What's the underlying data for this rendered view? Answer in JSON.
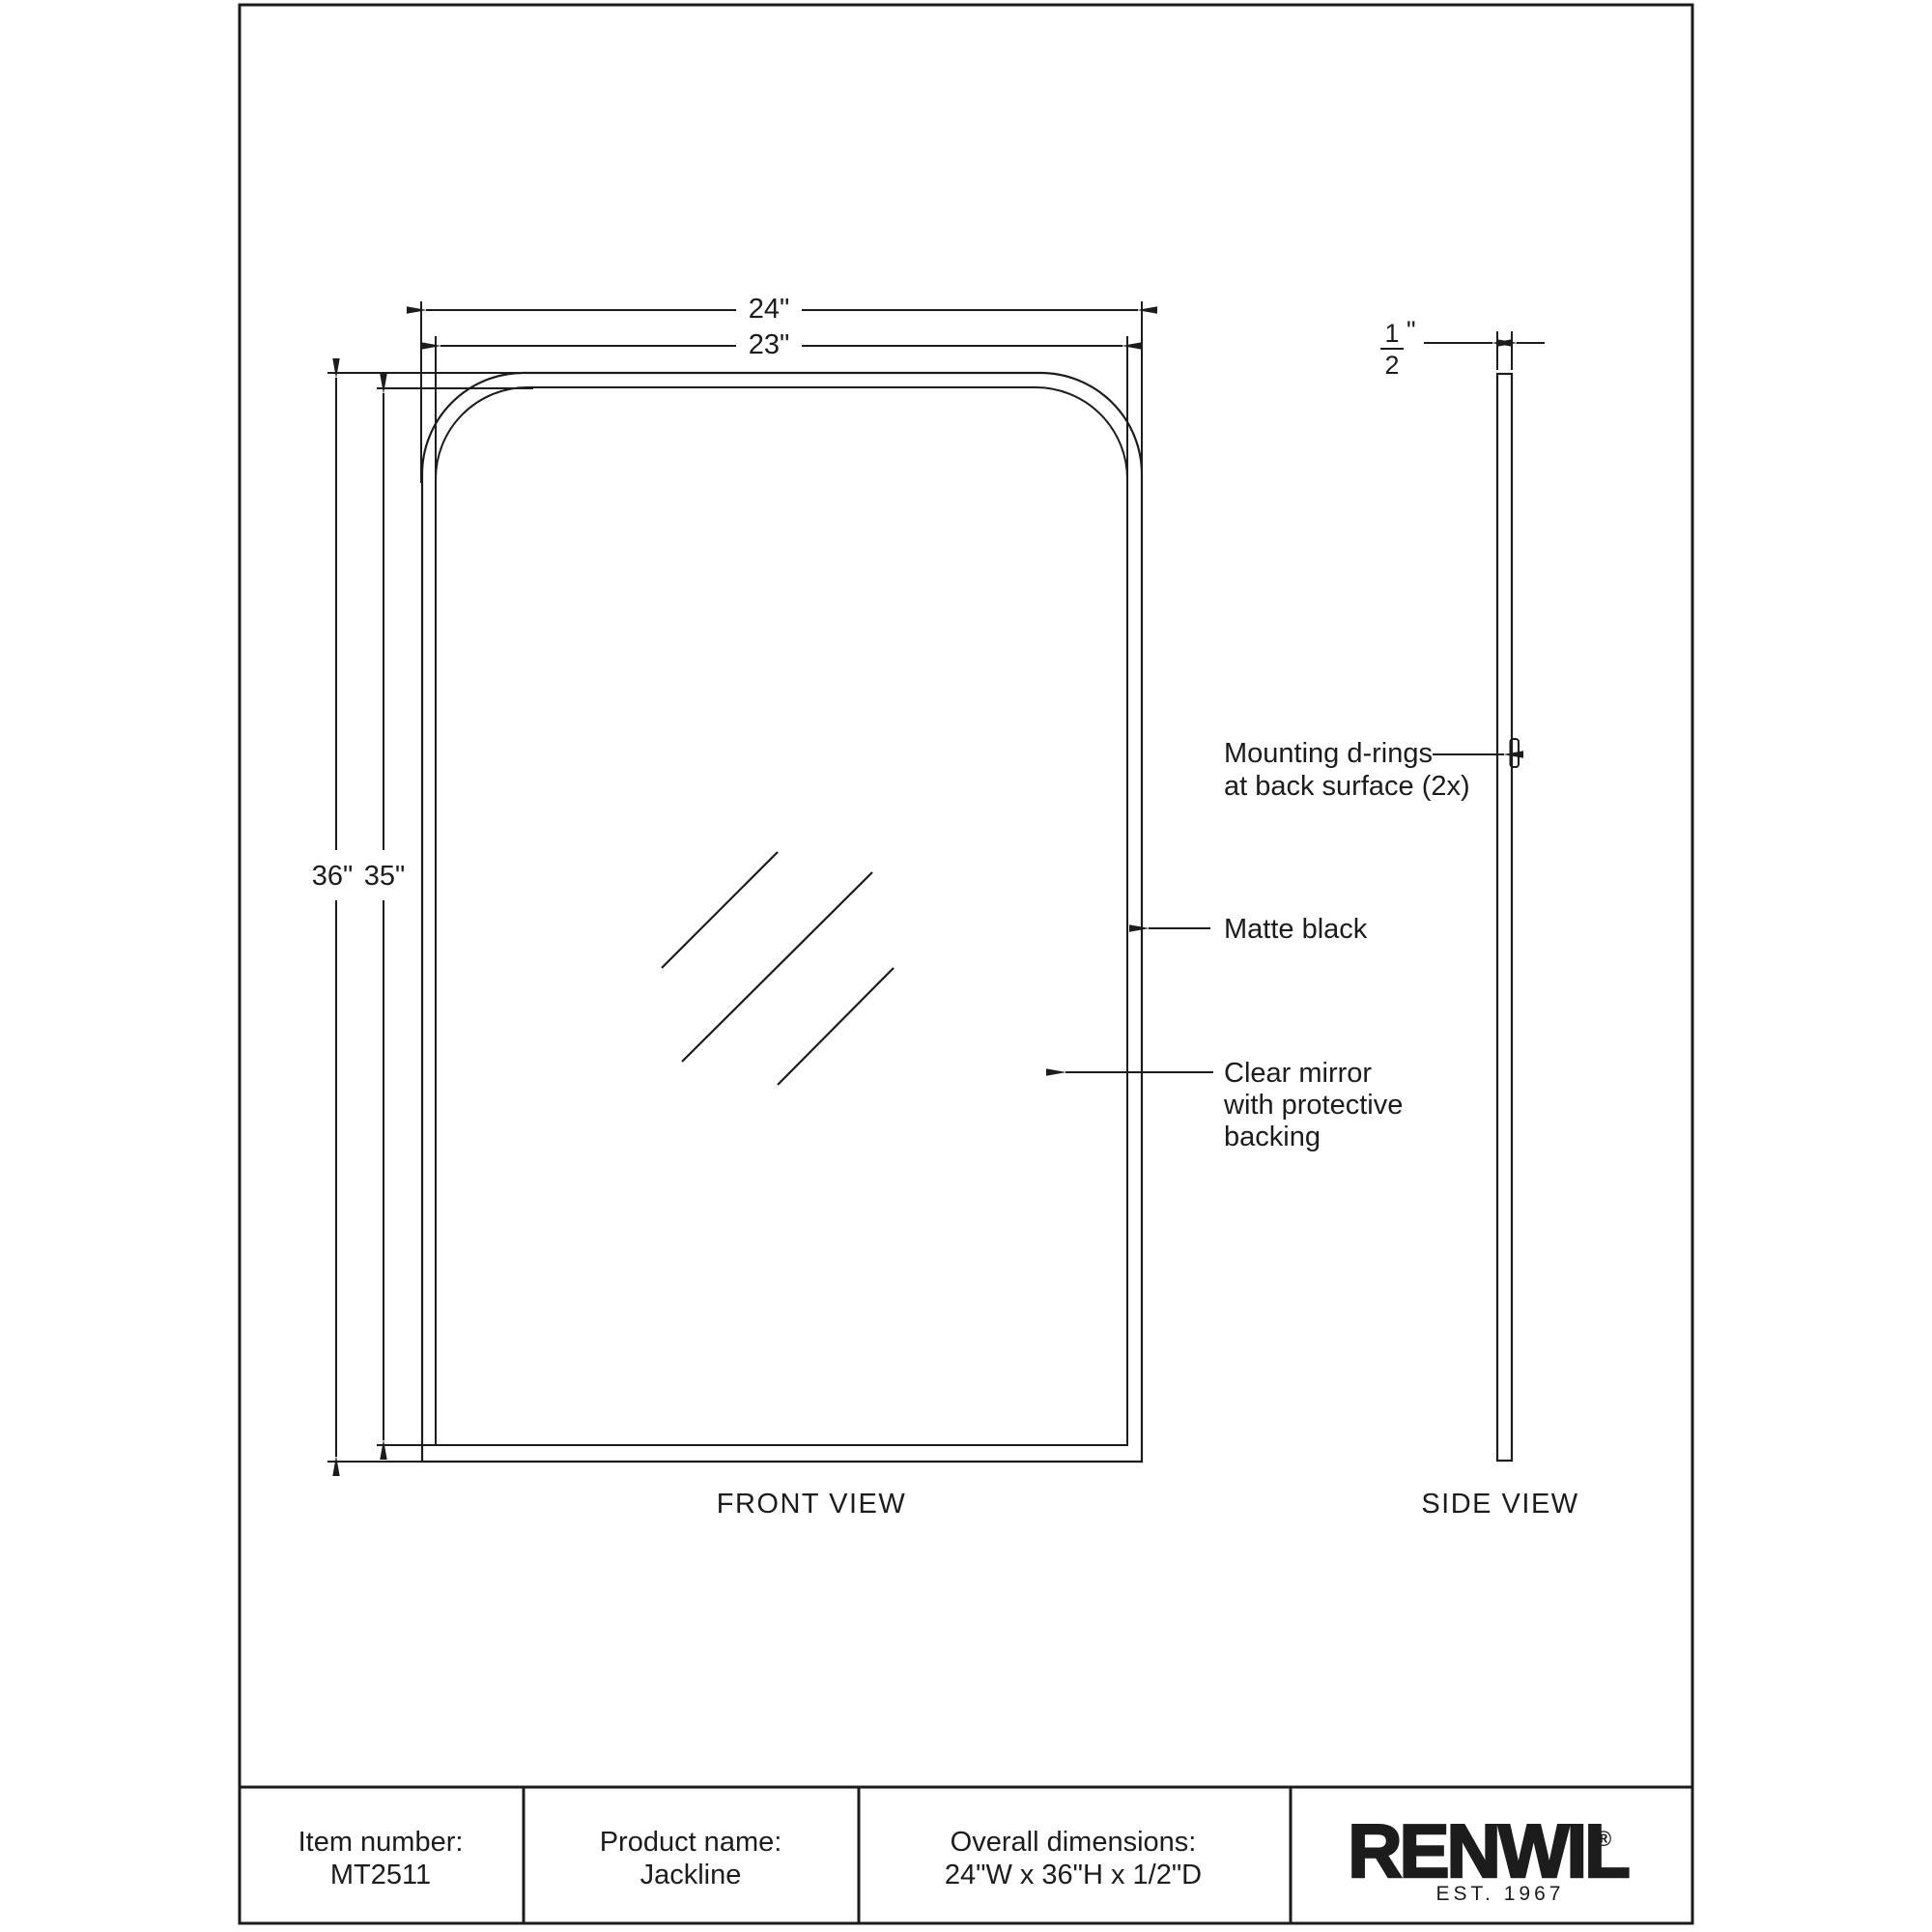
{
  "page": {
    "front_view": {
      "label": "FRONT VIEW",
      "dim_width_outer": "24\"",
      "dim_width_inner": "23\"",
      "dim_height_outer": "36\"",
      "dim_height_inner": "35\""
    },
    "side_view": {
      "label": "SIDE VIEW",
      "dim_depth": {
        "numerator": "1",
        "denominator": "2",
        "unit": "\""
      }
    },
    "annotations": {
      "mounting": {
        "line1": "Mounting d-rings",
        "line2": "at back surface (2x)"
      },
      "frame_finish": "Matte black",
      "mirror": {
        "line1": "Clear mirror",
        "line2": "with protective",
        "line3": "backing"
      }
    },
    "table": {
      "item_number_label": "Item number:",
      "item_number_value": "MT2511",
      "product_name_label": "Product name:",
      "product_name_value": "Jackline",
      "dimensions_label": "Overall dimensions:",
      "dimensions_value": "24\"W x 36\"H x 1/2\"D",
      "brand": {
        "name": "RENWIL",
        "registered": "®",
        "tagline": "EST. 1967"
      }
    },
    "colors": {
      "line": "#1c1c1c",
      "background": "#ffffff"
    }
  }
}
